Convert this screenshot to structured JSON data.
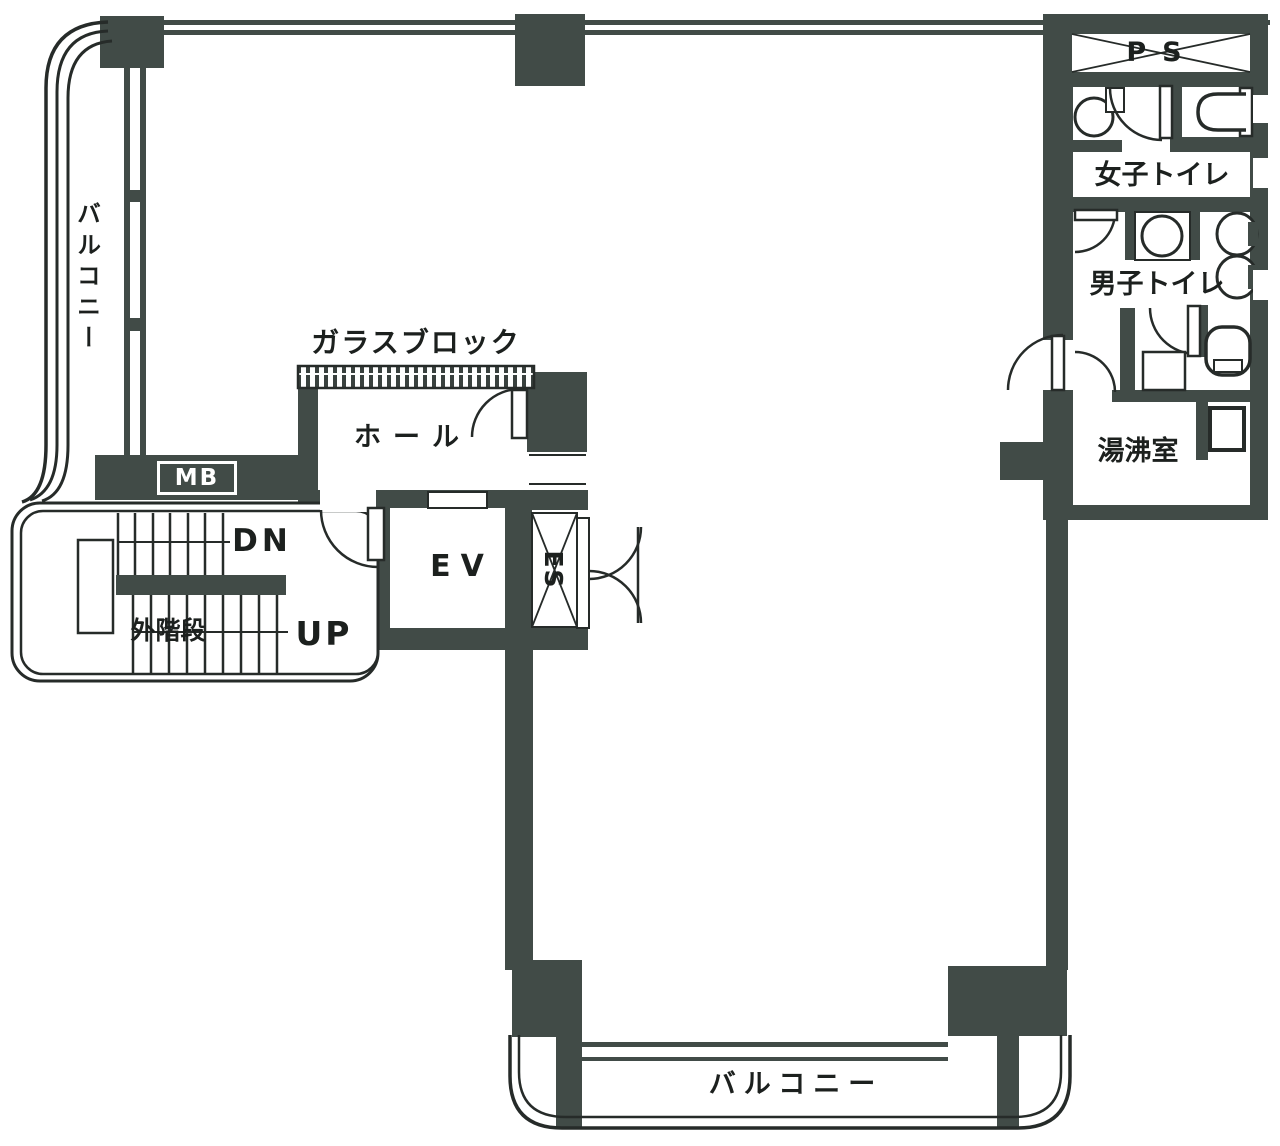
{
  "document": {
    "type": "building-floor-plan-scan",
    "language": "ja"
  },
  "colors": {
    "wall_fill": "#414b47",
    "line": "#262b29",
    "background": "#ffffff",
    "text": "#1c201e",
    "mb_box_text": "#ffffff"
  },
  "labels": {
    "balcony_left": "バルコニー",
    "balcony_bottom": "バルコニー",
    "glass_block": "ガラスブロック",
    "hall": "ホール",
    "mailbox": "MB",
    "down": "DN",
    "outside_stairs": "外階段",
    "up": "UP",
    "elevator": "EV",
    "es_shaft": "ES",
    "pipe_shaft": "PS",
    "womens_toilet": "女子トイレ",
    "mens_toilet": "男子トイレ",
    "hot_water_room": "湯沸室"
  }
}
